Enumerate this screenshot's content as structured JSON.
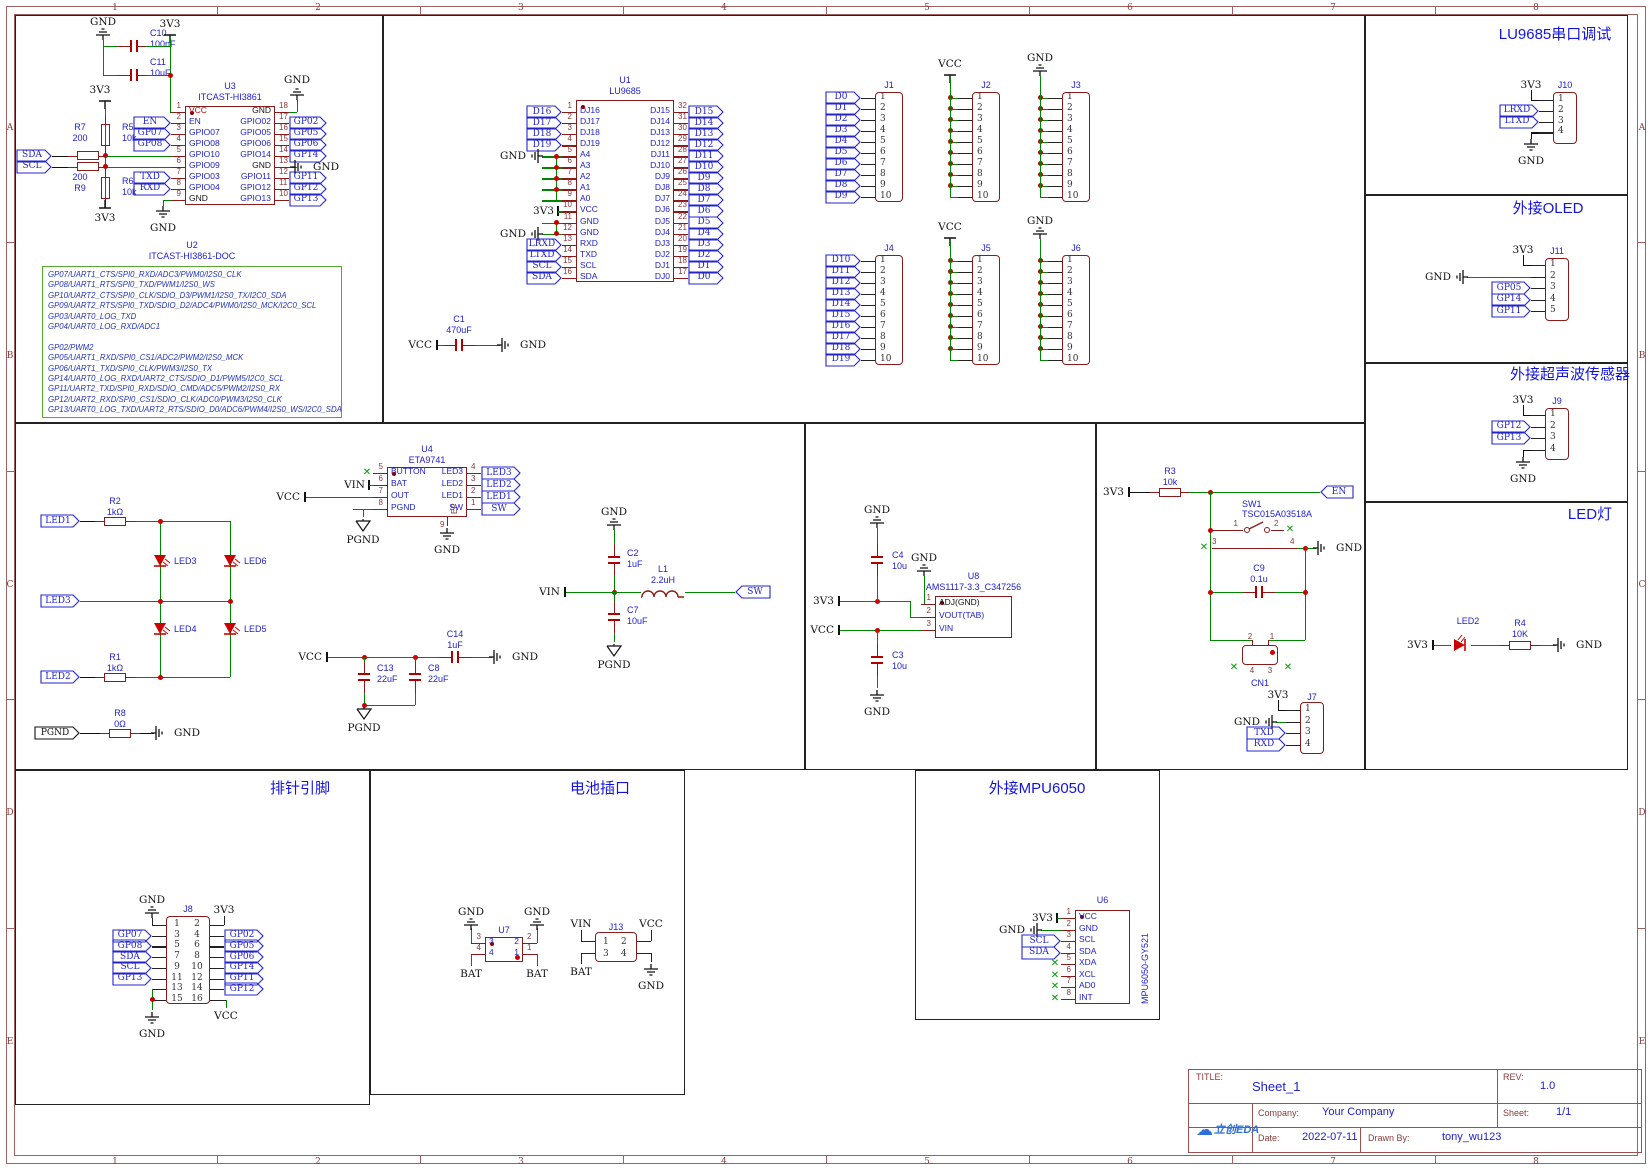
{
  "icons": {
    "x_mark": "✕",
    "cloud": "☁"
  },
  "frame": {
    "cols": [
      "1",
      "2",
      "3",
      "4",
      "5",
      "6",
      "7",
      "8"
    ],
    "rows": [
      "A",
      "B",
      "C",
      "D",
      "E"
    ]
  },
  "nets": {
    "gnd": "GND",
    "v33": "3V3",
    "vcc": "VCC",
    "pgnd": "PGND",
    "vin": "VIN",
    "bat": "BAT",
    "sw": "SW",
    "en": "EN",
    "sda": "SDA",
    "scl": "SCL"
  },
  "sections": {
    "lu9685_debug": "LU9685串口调试",
    "oled": "外接OLED",
    "ultrasonic": "外接超声波传感器",
    "led_lamp": "LED灯",
    "header_pins": "排针引脚",
    "battery": "电池插口",
    "mpu6050": "外接MPU6050"
  },
  "u2doc": {
    "ref": "U2",
    "value": "ITCAST-HI3861-DOC",
    "lines": [
      "GP07/UART1_CTS/SPI0_RXD/ADC3/PWM0/I2S0_CLK",
      "GP08/UART1_RTS/SPI0_TXD/PWM1/I2S0_WS",
      "GP10/UART2_CTS/SPI0_CLK/SDIO_D3/PWM1/I2S0_TX/I2C0_SDA",
      "GP09/UART2_RTS/SPI0_TXD/SDIO_D2/ADC4/PWM0/I2S0_MCK/I2C0_SCL",
      "GP03/UART0_LOG_TXD",
      "GP04/UART0_LOG_RXD/ADC1",
      "",
      "GP02/PWM2",
      "GP05/UART1_RXD/SPI0_CS1/ADC2/PWM2/I2S0_MCK",
      "GP06/UART1_TXD/SPI0_CLK/PWM3/I2S0_TX",
      "GP14/UART0_LOG_RXD/UART2_CTS/SDIO_D1/PWM5/I2C0_SCL",
      "GP11/UART2_TXD/SPI0_RXD/SDIO_CMD/ADC5/PWM2/I2S0_RX",
      "GP12/UART2_RXD/SPI0_CS1/SDIO_CLK/ADC0/PWM3/I2S0_CLK",
      "GP13/UART0_LOG_TXD/UART2_RTS/SDIO_D0/ADC6/PWM4/I2S0_WS/I2C0_SDA"
    ]
  },
  "ics": {
    "u3": {
      "ref": "U3",
      "value": "ITCAST-HI3861",
      "left": [
        [
          "1",
          "VCC",
          "",
          "",
          "r"
        ],
        [
          "2",
          "EN",
          "EN",
          "f"
        ],
        [
          "3",
          "GPIO07",
          "GP07",
          "f"
        ],
        [
          "4",
          "GPIO08",
          "GP08",
          "f"
        ],
        [
          "5",
          "GPIO10",
          "",
          "w"
        ],
        [
          "6",
          "GPIO09",
          "",
          "w"
        ],
        [
          "7",
          "GPIO03",
          "TXD",
          "f"
        ],
        [
          "8",
          "GPIO04",
          "RXD",
          "f"
        ],
        [
          "9",
          "GND",
          "",
          "g",
          "k"
        ]
      ],
      "right": [
        [
          "18",
          "GND",
          "",
          "gu",
          "k"
        ],
        [
          "17",
          "GPIO02",
          "GP02",
          "f"
        ],
        [
          "16",
          "GPIO05",
          "GP05",
          "f"
        ],
        [
          "15",
          "GPIO06",
          "GP06",
          "f"
        ],
        [
          "14",
          "GPIO14",
          "GP14",
          "f"
        ],
        [
          "13",
          "GND",
          "GND",
          "g2",
          "k"
        ],
        [
          "12",
          "GPIO11",
          "GP11",
          "f"
        ],
        [
          "11",
          "GPIO12",
          "GP12",
          "f"
        ],
        [
          "10",
          "GPIO13",
          "GP13",
          "f"
        ]
      ]
    },
    "u1": {
      "ref": "U1",
      "value": "LU9685",
      "left": [
        [
          "1",
          "DJ16",
          "D16",
          "f"
        ],
        [
          "2",
          "DJ17",
          "D17",
          "f"
        ],
        [
          "3",
          "DJ18",
          "D18",
          "f"
        ],
        [
          "4",
          "DJ19",
          "D19",
          "f"
        ],
        [
          "5",
          "A4",
          "GND",
          "g2"
        ],
        [
          "6",
          "A3",
          "",
          "w"
        ],
        [
          "7",
          "A2",
          "",
          "w"
        ],
        [
          "8",
          "A1",
          "",
          "w"
        ],
        [
          "9",
          "A0",
          "",
          "w"
        ],
        [
          "10",
          "VCC",
          "3V3",
          "p"
        ],
        [
          "11",
          "GND",
          "",
          "w"
        ],
        [
          "12",
          "GND",
          "GND",
          "g2"
        ],
        [
          "13",
          "RXD",
          "LRXD",
          "f"
        ],
        [
          "14",
          "TXD",
          "LTXD",
          "f"
        ],
        [
          "15",
          "SCL",
          "SCL",
          "f"
        ],
        [
          "16",
          "SDA",
          "SDA",
          "f"
        ]
      ],
      "right": [
        [
          "32",
          "DJ15",
          "D15",
          "f"
        ],
        [
          "31",
          "DJ14",
          "D14",
          "f"
        ],
        [
          "30",
          "DJ13",
          "D13",
          "f"
        ],
        [
          "29",
          "DJ12",
          "D12",
          "f"
        ],
        [
          "28",
          "DJ11",
          "D11",
          "f"
        ],
        [
          "27",
          "DJ10",
          "D10",
          "f"
        ],
        [
          "26",
          "DJ9",
          "D9",
          "f"
        ],
        [
          "25",
          "DJ8",
          "D8",
          "f"
        ],
        [
          "24",
          "DJ7",
          "D7",
          "f"
        ],
        [
          "23",
          "DJ6",
          "D6",
          "f"
        ],
        [
          "22",
          "DJ5",
          "D5",
          "f"
        ],
        [
          "21",
          "DJ4",
          "D4",
          "f"
        ],
        [
          "20",
          "DJ3",
          "D3",
          "f"
        ],
        [
          "19",
          "DJ2",
          "D2",
          "f"
        ],
        [
          "18",
          "DJ1",
          "D1",
          "f"
        ],
        [
          "17",
          "DJ0",
          "D0",
          "f"
        ]
      ]
    },
    "u4": {
      "ref": "U4",
      "value": "ETA9741",
      "ep": "EP",
      "ep_pin": "9",
      "left": [
        [
          "5",
          "BUTTON",
          "",
          "x"
        ],
        [
          "6",
          "BAT",
          "VIN",
          "p"
        ],
        [
          "7",
          "OUT",
          "VCC",
          "w"
        ],
        [
          "8",
          "PGND",
          "",
          "w"
        ]
      ],
      "right": [
        [
          "4",
          "LED3",
          "LED3",
          "f"
        ],
        [
          "3",
          "LED2",
          "LED2",
          "f"
        ],
        [
          "2",
          "LED1",
          "LED1",
          "f"
        ],
        [
          "1",
          "SW",
          "SW",
          "f"
        ]
      ]
    },
    "u8": {
      "ref": "U8",
      "value": "AMS1117-3.3_C347256",
      "left": [
        [
          "1",
          "ADJ(GND)",
          "",
          "",
          "k"
        ],
        [
          "2",
          "VOUT(TAB)",
          "",
          ""
        ],
        [
          "3",
          "VIN",
          "",
          ""
        ]
      ]
    },
    "u7": {
      "ref": "U7",
      "left": [
        [
          "3",
          "3",
          "",
          ""
        ],
        [
          "4",
          "4",
          "",
          ""
        ]
      ],
      "right": [
        [
          "2",
          "2",
          "",
          ""
        ],
        [
          "1",
          "1",
          "",
          ""
        ]
      ]
    },
    "u6": {
      "ref": "U6",
      "value": "MPU6050-GY521",
      "left": [
        [
          "1",
          "VCC",
          "3V3",
          "p"
        ],
        [
          "2",
          "GND",
          "",
          "g2"
        ],
        [
          "3",
          "SCL",
          "SCL",
          "f"
        ],
        [
          "4",
          "SDA",
          "SDA",
          "f"
        ],
        [
          "5",
          "XDA",
          "",
          "x"
        ],
        [
          "6",
          "XCL",
          "",
          "x"
        ],
        [
          "7",
          "AD0",
          "",
          "x"
        ],
        [
          "8",
          "INT",
          "",
          "x"
        ]
      ]
    }
  },
  "conns": {
    "j1": {
      "ref": "J1",
      "pins": [
        "1",
        "2",
        "3",
        "4",
        "5",
        "6",
        "7",
        "8",
        "9",
        "10"
      ],
      "nets": [
        "D0",
        "D1",
        "D2",
        "D3",
        "D4",
        "D5",
        "D6",
        "D7",
        "D8",
        "D9"
      ]
    },
    "j2": {
      "ref": "J2",
      "pins": [
        "1",
        "2",
        "3",
        "4",
        "5",
        "6",
        "7",
        "8",
        "9",
        "10"
      ],
      "bus": "VCC"
    },
    "j3": {
      "ref": "J3",
      "pins": [
        "1",
        "2",
        "3",
        "4",
        "5",
        "6",
        "7",
        "8",
        "9",
        "10"
      ],
      "bus": "GND"
    },
    "j4": {
      "ref": "J4",
      "pins": [
        "1",
        "2",
        "3",
        "4",
        "5",
        "6",
        "7",
        "8",
        "9",
        "10"
      ],
      "nets": [
        "D10",
        "D11",
        "D12",
        "D13",
        "D14",
        "D15",
        "D16",
        "D17",
        "D18",
        "D19"
      ]
    },
    "j5": {
      "ref": "J5",
      "pins": [
        "1",
        "2",
        "3",
        "4",
        "5",
        "6",
        "7",
        "8",
        "9",
        "10"
      ],
      "bus": "VCC"
    },
    "j6": {
      "ref": "J6",
      "pins": [
        "1",
        "2",
        "3",
        "4",
        "5",
        "6",
        "7",
        "8",
        "9",
        "10"
      ],
      "bus": "GND"
    },
    "j7": {
      "ref": "J7",
      "rows": [
        [
          "1",
          "3V3",
          "p"
        ],
        [
          "2",
          "GND",
          "g2"
        ],
        [
          "3",
          "TXD",
          "f"
        ],
        [
          "4",
          "RXD",
          "f"
        ]
      ]
    },
    "j8": {
      "ref": "J8",
      "left_pins": [
        "1",
        "3",
        "5",
        "7",
        "9",
        "11",
        "13",
        "15"
      ],
      "right_pins": [
        "2",
        "4",
        "6",
        "8",
        "10",
        "12",
        "14",
        "16"
      ],
      "left_nets": [
        "",
        "GP07",
        "GP08",
        "SDA",
        "SCL",
        "GP13",
        "",
        ""
      ],
      "right_nets": [
        "",
        "GP02",
        "GP05",
        "GP06",
        "GP14",
        "GP11",
        "GP12",
        ""
      ]
    },
    "j9": {
      "ref": "J9",
      "rows": [
        [
          "1",
          "3V3",
          "p"
        ],
        [
          "2",
          "GP12",
          "f"
        ],
        [
          "3",
          "GP13",
          "f"
        ],
        [
          "4",
          "GND",
          "g"
        ]
      ]
    },
    "j10": {
      "ref": "J10",
      "rows": [
        [
          "1",
          "3V3",
          "p"
        ],
        [
          "2",
          "LRXD",
          "f"
        ],
        [
          "3",
          "LTXD",
          "f"
        ],
        [
          "4",
          "GND",
          "g"
        ]
      ]
    },
    "j11": {
      "ref": "J11",
      "rows": [
        [
          "1",
          "3V3",
          "p"
        ],
        [
          "2",
          "GND",
          "gl"
        ],
        [
          "3",
          "GP05",
          "f"
        ],
        [
          "4",
          "GP14",
          "f"
        ],
        [
          "5",
          "GP11",
          "f"
        ]
      ]
    },
    "j13": {
      "ref": "J13",
      "pins": [
        "1",
        "2",
        "3",
        "4"
      ]
    },
    "sw1": {
      "ref": "SW1",
      "value": "TSC015A03518A",
      "pins": [
        "1",
        "2",
        "3",
        "4"
      ]
    },
    "cn1": {
      "ref": "CN1",
      "pins": [
        "1",
        "2",
        "3",
        "4"
      ]
    }
  },
  "passives": {
    "r1": [
      "R1",
      "1kΩ"
    ],
    "r2": [
      "R2",
      "1kΩ"
    ],
    "r3": [
      "R3",
      "10k"
    ],
    "r4": [
      "R4",
      "10K"
    ],
    "r5": [
      "R5",
      "10k"
    ],
    "r6": [
      "R6",
      "10k"
    ],
    "r7": [
      "R7",
      "200"
    ],
    "r8": [
      "R8",
      "0Ω"
    ],
    "r9": [
      "R9",
      "200"
    ],
    "c1": [
      "C1",
      "470uF"
    ],
    "c2": [
      "C2",
      "1uF"
    ],
    "c3": [
      "C3",
      "10u"
    ],
    "c4": [
      "C4",
      "10u"
    ],
    "c7": [
      "C7",
      "10uF"
    ],
    "c8": [
      "C8",
      "22uF"
    ],
    "c9": [
      "C9",
      "0.1u"
    ],
    "c10": [
      "C10",
      "100nF"
    ],
    "c11": [
      "C11",
      "10uF"
    ],
    "c13": [
      "C13",
      "22uF"
    ],
    "c14": [
      "C14",
      "1uF"
    ],
    "l1": [
      "L1",
      "2.2uH"
    ]
  },
  "leds": {
    "led2": "LED2",
    "led3": "LED3",
    "led4": "LED4",
    "led5": "LED5",
    "led6": "LED6"
  },
  "matrix": [
    "LED1",
    "LED3",
    "LED2"
  ],
  "titleblock": {
    "title_label": "TITLE:",
    "title": "Sheet_1",
    "rev_label": "REV:",
    "rev": "1.0",
    "company_label": "Company:",
    "company": "Your Company",
    "sheet_label": "Sheet:",
    "sheet": "1/1",
    "date_label": "Date:",
    "date": "2022-07-11",
    "drawn_label": "Drawn By:",
    "drawn": "tony_wu123",
    "logo_text": "立创EDA"
  }
}
